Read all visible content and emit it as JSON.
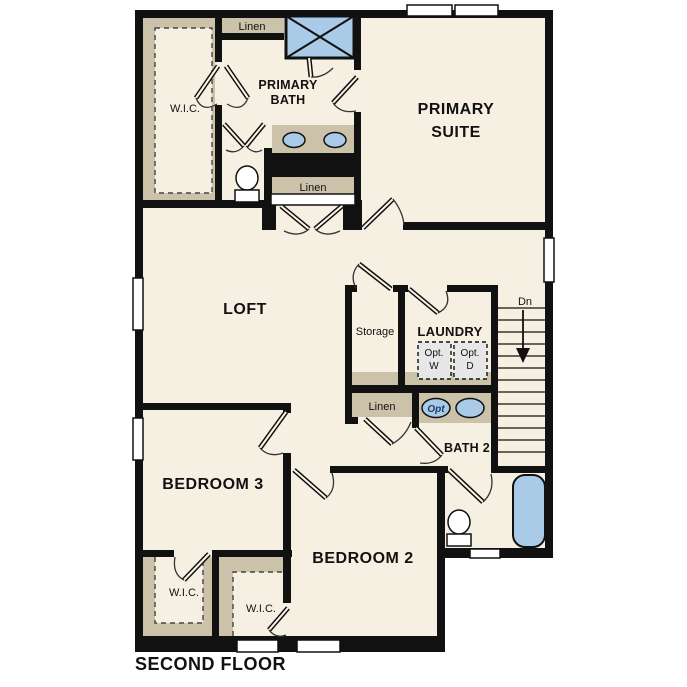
{
  "plan": {
    "title": "SECOND FLOOR",
    "stairs": {
      "direction_label": "Dn"
    },
    "rooms": {
      "primary_suite": {
        "line1": "PRIMARY",
        "line2": "SUITE"
      },
      "primary_bath": {
        "line1": "PRIMARY",
        "line2": "BATH"
      },
      "loft": {
        "label": "LOFT"
      },
      "storage": {
        "label": "Storage"
      },
      "laundry": {
        "label": "LAUNDRY"
      },
      "bath2": {
        "label": "BATH 2"
      },
      "bedroom3": {
        "label": "BEDROOM 3"
      },
      "bedroom2": {
        "label": "BEDROOM 2"
      }
    },
    "closets": {
      "wic_primary": {
        "label": "W.I.C."
      },
      "wic_bedroom3": {
        "label": "W.I.C."
      },
      "wic_bedroom2": {
        "label": "W.I.C."
      },
      "linen_upper": {
        "label": "Linen"
      },
      "linen_primary": {
        "label": "Linen"
      },
      "linen_hall": {
        "label": "Linen"
      }
    },
    "options": {
      "washer": {
        "line1": "Opt.",
        "line2": "W"
      },
      "dryer": {
        "line1": "Opt.",
        "line2": "D"
      },
      "sink": {
        "label": "Opt"
      }
    },
    "colors": {
      "floor": "#f6f0e2",
      "carpet_tan": "#ccc2a9",
      "wall": "#111111",
      "fixture_blue": "#a9cbe8",
      "option_gray": "#e7e7e7",
      "text": "#111111",
      "opt_sink_text": "#1d3d6e"
    }
  }
}
